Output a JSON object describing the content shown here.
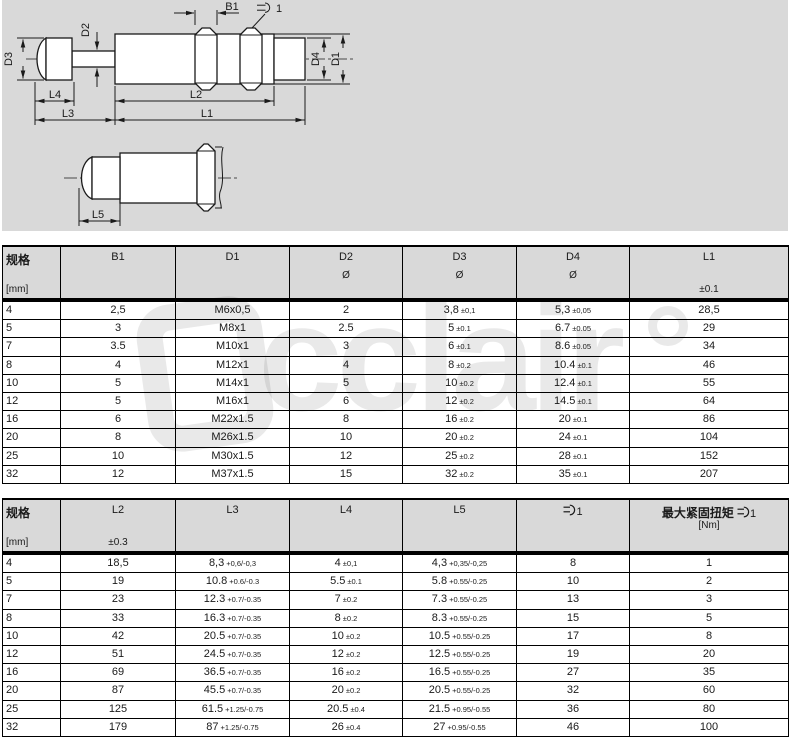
{
  "colors": {
    "panel_background": "#d9d9d9",
    "table_header_background": "#d9d9d9",
    "line_color": "#1a1a1a",
    "text_color": "#1a1a1a"
  },
  "drawing": {
    "labels": {
      "b1": "B1",
      "wrench_num": "1",
      "d2": "D2",
      "d3": "D3",
      "d4": "D4",
      "d1": "D1",
      "l4": "L4",
      "l3": "L3",
      "l2": "L2",
      "l1": "L1",
      "l5": "L5"
    }
  },
  "watermark": {
    "text": "cclair"
  },
  "tables": {
    "table1": {
      "header": {
        "spec": "规格",
        "unit": "[mm]",
        "b1": "B1",
        "d1": "D1",
        "d2": "D2",
        "d3": "D3",
        "d4": "D4",
        "diameter_symbol": "Ø",
        "l1": "L1",
        "l1_tol": "±0.1"
      },
      "rows": [
        [
          "4",
          "2,5",
          "M6x0,5",
          "2",
          {
            "v": "3,8",
            "t": "±0,1"
          },
          {
            "v": "5,3",
            "t": "±0,05"
          },
          "28,5"
        ],
        [
          "5",
          "3",
          "M8x1",
          "2.5",
          {
            "v": "5",
            "t": "±0.1"
          },
          {
            "v": "6.7",
            "t": "±0.05"
          },
          "29"
        ],
        [
          "7",
          "3.5",
          "M10x1",
          "3",
          {
            "v": "6",
            "t": "±0.1"
          },
          {
            "v": "8.6",
            "t": "±0.05"
          },
          "34"
        ],
        [
          "8",
          "4",
          "M12x1",
          "4",
          {
            "v": "8",
            "t": "±0.2"
          },
          {
            "v": "10.4",
            "t": "±0.1"
          },
          "46"
        ],
        [
          "10",
          "5",
          "M14x1",
          "5",
          {
            "v": "10",
            "t": "±0.2"
          },
          {
            "v": "12.4",
            "t": "±0.1"
          },
          "55"
        ],
        [
          "12",
          "5",
          "M16x1",
          "6",
          {
            "v": "12",
            "t": "±0.2"
          },
          {
            "v": "14.5",
            "t": "±0.1"
          },
          "64"
        ],
        [
          "16",
          "6",
          "M22x1.5",
          "8",
          {
            "v": "16",
            "t": "±0.2"
          },
          {
            "v": "20",
            "t": "±0.1"
          },
          "86"
        ],
        [
          "20",
          "8",
          "M26x1.5",
          "10",
          {
            "v": "20",
            "t": "±0.2"
          },
          {
            "v": "24",
            "t": "±0.1"
          },
          "104"
        ],
        [
          "25",
          "10",
          "M30x1.5",
          "12",
          {
            "v": "25",
            "t": "±0.2"
          },
          {
            "v": "28",
            "t": "±0.1"
          },
          "152"
        ],
        [
          "32",
          "12",
          "M37x1.5",
          "15",
          {
            "v": "32",
            "t": "±0.2"
          },
          {
            "v": "35",
            "t": "±0.1"
          },
          "207"
        ]
      ]
    },
    "table2": {
      "header": {
        "spec": "规格",
        "unit": "[mm]",
        "l2": "L2",
        "l2_tol": "±0.3",
        "l3": "L3",
        "l4": "L4",
        "l5": "L5",
        "wrench_num": "1",
        "torque_label": "最大紧固扭矩",
        "torque_num": "1",
        "torque_unit": "[Nm]"
      },
      "rows": [
        [
          "4",
          "18,5",
          {
            "v": "8,3",
            "t": "+0,6/-0,3"
          },
          {
            "v": "4",
            "t": "±0,1"
          },
          {
            "v": "4,3",
            "t": "+0,35/-0,25"
          },
          "8",
          "1"
        ],
        [
          "5",
          "19",
          {
            "v": "10.8",
            "t": "+0.6/-0.3"
          },
          {
            "v": "5.5",
            "t": "±0.1"
          },
          {
            "v": "5.8",
            "t": "+0.55/-0.25"
          },
          "10",
          "2"
        ],
        [
          "7",
          "23",
          {
            "v": "12.3",
            "t": "+0.7/-0.35"
          },
          {
            "v": "7",
            "t": "±0.2"
          },
          {
            "v": "7.3",
            "t": "+0.55/-0.25"
          },
          "13",
          "3"
        ],
        [
          "8",
          "33",
          {
            "v": "16.3",
            "t": "+0.7/-0.35"
          },
          {
            "v": "8",
            "t": "±0.2"
          },
          {
            "v": "8.3",
            "t": "+0.55/-0.25"
          },
          "15",
          "5"
        ],
        [
          "10",
          "42",
          {
            "v": "20.5",
            "t": "+0.7/-0.35"
          },
          {
            "v": "10",
            "t": "±0.2"
          },
          {
            "v": "10.5",
            "t": "+0.55/-0.25"
          },
          "17",
          "8"
        ],
        [
          "12",
          "51",
          {
            "v": "24.5",
            "t": "+0.7/-0.35"
          },
          {
            "v": "12",
            "t": "±0.2"
          },
          {
            "v": "12.5",
            "t": "+0.55/-0.25"
          },
          "19",
          "20"
        ],
        [
          "16",
          "69",
          {
            "v": "36.5",
            "t": "+0.7/-0.35"
          },
          {
            "v": "16",
            "t": "±0.2"
          },
          {
            "v": "16.5",
            "t": "+0.55/-0.25"
          },
          "27",
          "35"
        ],
        [
          "20",
          "87",
          {
            "v": "45.5",
            "t": "+0.7/-0.35"
          },
          {
            "v": "20",
            "t": "±0.2"
          },
          {
            "v": "20.5",
            "t": "+0.55/-0.25"
          },
          "32",
          "60"
        ],
        [
          "25",
          "125",
          {
            "v": "61.5",
            "t": "+1.25/-0.75"
          },
          {
            "v": "20.5",
            "t": "±0.4"
          },
          {
            "v": "21.5",
            "t": "+0.95/-0.55"
          },
          "36",
          "80"
        ],
        [
          "32",
          "179",
          {
            "v": "87",
            "t": "+1.25/-0.75"
          },
          {
            "v": "26",
            "t": "±0.4"
          },
          {
            "v": "27",
            "t": "+0.95/-0.55"
          },
          "46",
          "100"
        ]
      ]
    }
  }
}
